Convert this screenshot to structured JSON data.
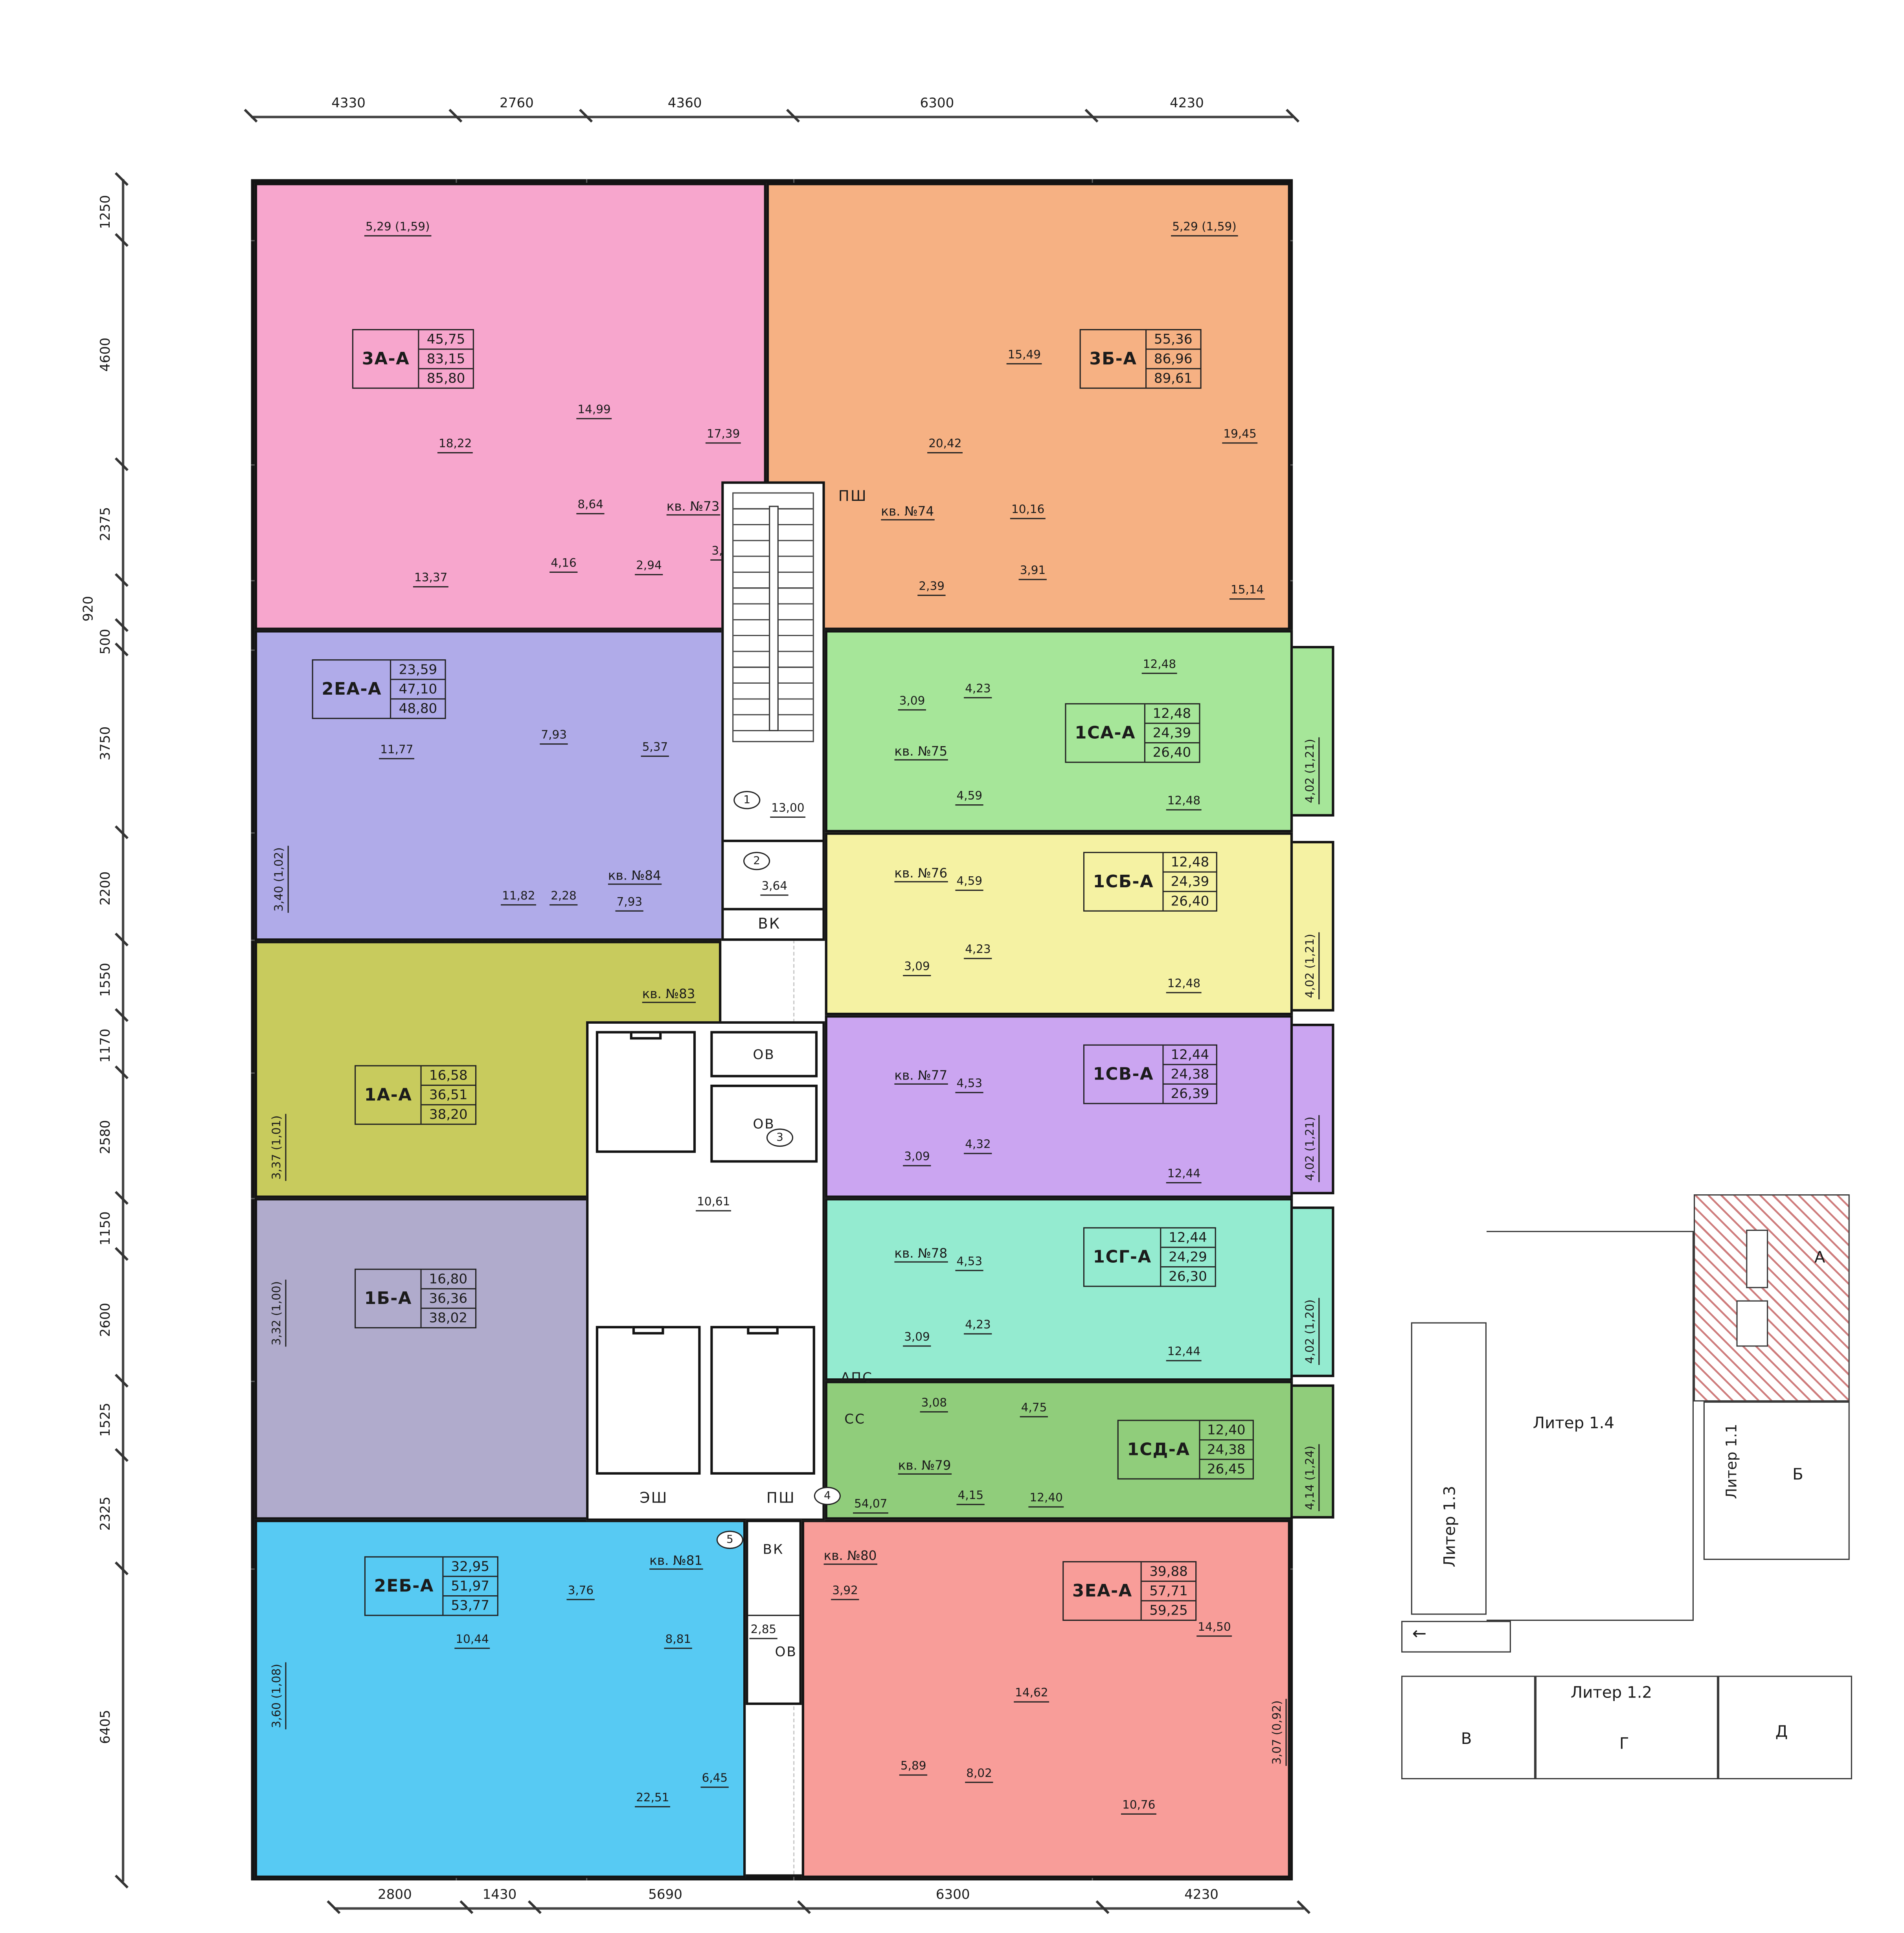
{
  "dims": {
    "top": [
      "4330",
      "2760",
      "4360",
      "6300",
      "4230"
    ],
    "left": [
      "1250",
      "4600",
      "2375",
      "920",
      "500",
      "3750",
      "2200",
      "1550",
      "1170",
      "2580",
      "1150",
      "2600",
      "1525",
      "2325",
      "6405"
    ],
    "bottom": [
      "2800",
      "1430",
      "5690",
      "6300",
      "4230"
    ]
  },
  "apartments": [
    {
      "name": "3А-А",
      "areas": [
        "45,75",
        "83,15",
        "85,80"
      ],
      "unit": "кв. №73",
      "color": "#f7a6cd",
      "rooms": [
        "5,29 (1,59)",
        "18,22",
        "14,99",
        "17,39",
        "8,64",
        "13,37",
        "4,16",
        "2,94",
        "3,44"
      ]
    },
    {
      "name": "3Б-А",
      "areas": [
        "55,36",
        "86,96",
        "89,61"
      ],
      "unit": "кв. №74",
      "color": "#f6b183",
      "rooms": [
        "5,29 (1,59)",
        "15,49",
        "20,42",
        "19,45",
        "10,16",
        "2,39",
        "3,91",
        "15,14"
      ]
    },
    {
      "name": "2ЕА-А",
      "areas": [
        "23,59",
        "47,10",
        "48,80"
      ],
      "unit": "кв. №84",
      "color": "#b0abe9",
      "rooms": [
        "11,77",
        "7,93",
        "5,37",
        "3,40 (1,02)",
        "11,82",
        "2,28",
        "7,93"
      ]
    },
    {
      "name": "1СА-А",
      "areas": [
        "12,48",
        "24,39",
        "26,40"
      ],
      "unit": "кв. №75",
      "color": "#a6e699",
      "rooms": [
        "3,09",
        "4,23",
        "12,48",
        "4,59",
        "12,48"
      ],
      "balcony": "4,02 (1,21)"
    },
    {
      "name": "1СБ-А",
      "areas": [
        "12,48",
        "24,39",
        "26,40"
      ],
      "unit": "кв. №76",
      "color": "#f5f2a3",
      "rooms": [
        "4,59",
        "3,09",
        "4,23",
        "12,48"
      ],
      "balcony": "4,02 (1,21)"
    },
    {
      "name": "1СВ-А",
      "areas": [
        "12,44",
        "24,38",
        "26,39"
      ],
      "unit": "кв. №77",
      "color": "#cba5f1",
      "rooms": [
        "4,53",
        "3,09",
        "4,32",
        "12,44"
      ],
      "balcony": "4,02 (1,21)"
    },
    {
      "name": "1СГ-А",
      "areas": [
        "12,44",
        "24,29",
        "26,30"
      ],
      "unit": "кв. №78",
      "color": "#94ebd0",
      "rooms": [
        "4,53",
        "3,09",
        "4,23",
        "12,44"
      ],
      "balcony": "4,02 (1,20)"
    },
    {
      "name": "1СД-А",
      "areas": [
        "12,40",
        "24,38",
        "26,45"
      ],
      "unit": "кв. №79",
      "color": "#90cd7b",
      "rooms": [
        "3,08",
        "4,75",
        "4,15",
        "12,40"
      ],
      "balcony": "4,14 (1,24)"
    },
    {
      "name": "1А-А",
      "areas": [
        "16,58",
        "36,51",
        "38,20"
      ],
      "unit": "кв. №83",
      "color": "#c8cb5d",
      "rooms": [
        "16,58",
        "10,38",
        "5,95",
        "3,37 (1,01)",
        "3,60"
      ]
    },
    {
      "name": "1Б-А",
      "areas": [
        "16,80",
        "36,36",
        "38,02"
      ],
      "unit": "кв. №82",
      "color": "#b0abcc",
      "rooms": [
        "3,32 (1,00)",
        "3,60",
        "10,21",
        "16,80",
        "5,75"
      ]
    },
    {
      "name": "2ЕБ-А",
      "areas": [
        "32,95",
        "51,97",
        "53,77"
      ],
      "unit": "кв. №81",
      "color": "#57caf3",
      "rooms": [
        "3,60 (1,08)",
        "3,76",
        "10,44",
        "8,81",
        "22,51",
        "6,45"
      ]
    },
    {
      "name": "3ЕА-А",
      "areas": [
        "39,88",
        "57,71",
        "59,25"
      ],
      "unit": "кв. №80",
      "color": "#f89d99",
      "rooms": [
        "3,92",
        "14,62",
        "14,50",
        "5,89",
        "8,02",
        "10,76",
        "3,07 (0,92)"
      ]
    }
  ],
  "core": {
    "stair_num": "1",
    "stair_area": "13,00",
    "tambour_num": "2",
    "tambour_area": "3,64",
    "vk": "ВК",
    "psh_top": "ПШ",
    "ov1": "ОВ",
    "ov2": "ОВ",
    "lobby_num": "3",
    "lobby_area": "10,61",
    "esh": "ЭШ",
    "psh": "ПШ",
    "aps": "АПС",
    "ss": "СС",
    "corr_num": "4",
    "corr_area": "54,07",
    "entry_num": "5",
    "vk2": "ВК",
    "ov3": "ОВ",
    "ov3_area": "2,85"
  },
  "site_plan": {
    "l11": "Литер 1.1",
    "l12": "Литер 1.2",
    "l13": "Литер 1.3",
    "l14": "Литер 1.4",
    "bl_a": "А",
    "bl_b": "Б",
    "bl_v": "В",
    "bl_g": "Г",
    "bl_d": "Д"
  }
}
